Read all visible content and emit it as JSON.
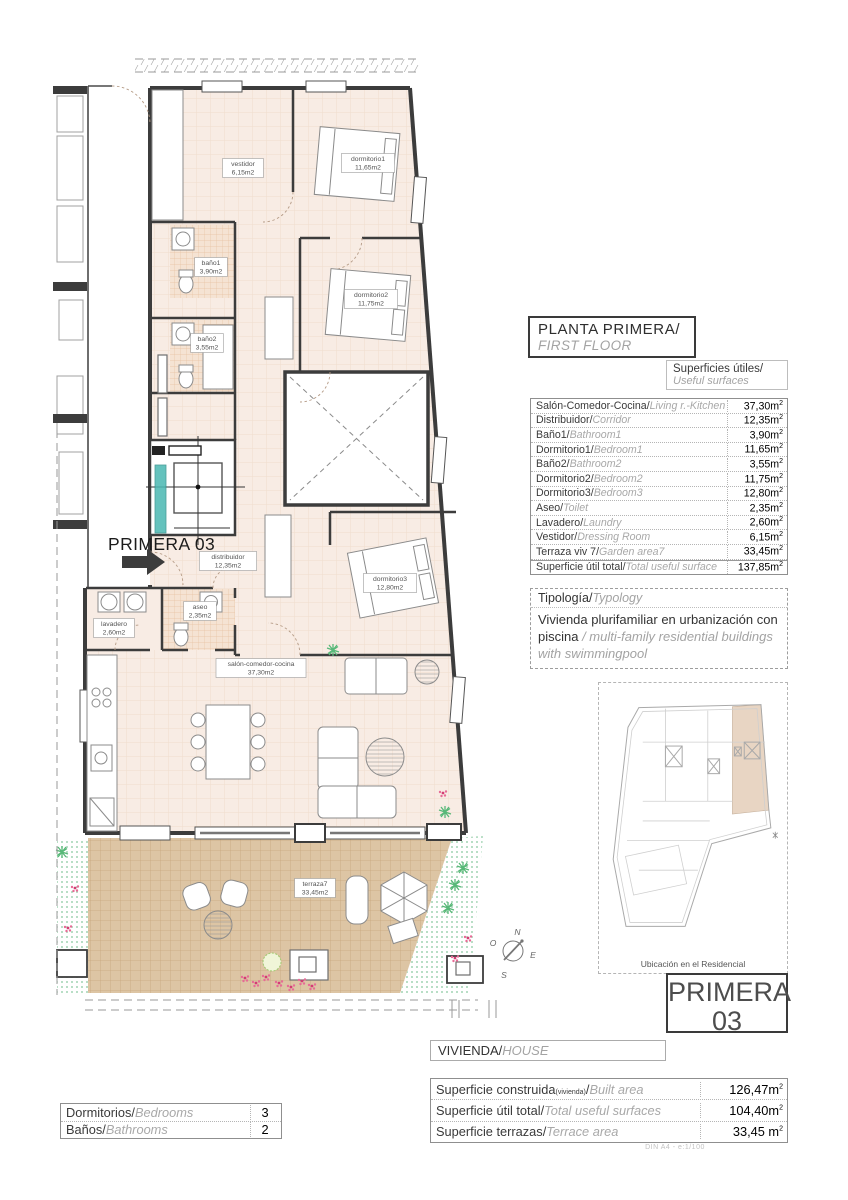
{
  "header": {
    "title_es": "PLANTA PRIMERA/",
    "title_en": "FIRST FLOOR"
  },
  "surfaces": {
    "header_es": "Superficies útiles/",
    "header_en": "Useful surfaces",
    "unit": "m2",
    "rows": [
      {
        "es": "Salón-Comedor-Cocina",
        "en": "Living r.-Kitchen",
        "value": "37,30"
      },
      {
        "es": "Distribuidor",
        "en": "Corridor",
        "value": "12,35"
      },
      {
        "es": "Baño1",
        "en": "Bathroom1",
        "value": "3,90"
      },
      {
        "es": "Dormitorio1",
        "en": "Bedroom1",
        "value": "11,65"
      },
      {
        "es": "Baño2",
        "en": "Bathroom2",
        "value": "3,55"
      },
      {
        "es": "Dormitorio2",
        "en": "Bedroom2",
        "value": "11,75"
      },
      {
        "es": "Dormitorio3",
        "en": "Bedroom3",
        "value": "12,80"
      },
      {
        "es": "Aseo",
        "en": "Toilet",
        "value": "2,35"
      },
      {
        "es": "Lavadero",
        "en": "Laundry",
        "value": "2,60"
      },
      {
        "es": "Vestidor",
        "en": "Dressing Room",
        "value": "6,15"
      },
      {
        "es": "Terraza viv 7",
        "en": "Garden area7",
        "value": "33,45"
      },
      {
        "es": "Superficie útil total",
        "en": "Total useful surface",
        "value": "137,85"
      }
    ]
  },
  "typology": {
    "header_es": "Tipología/",
    "header_en": "Typology",
    "body_es": "Vivienda plurifamiliar en urbanización con piscina ",
    "body_en": "/ multi-family residential buildings with swimmingpool"
  },
  "location_map": {
    "caption": "Ubicación en el Residencial"
  },
  "unit_badge": {
    "line1": "PRIMERA",
    "line2": "03"
  },
  "vivienda": {
    "es": "VIVIENDA/",
    "en": "HOUSE"
  },
  "totals": {
    "rows": [
      {
        "es": "Superficie construida",
        "small": "(vivienda)",
        "en": "Built area",
        "value": "126,47"
      },
      {
        "es": "Superficie útil total",
        "en": "Total useful surfaces",
        "value": "104,40"
      },
      {
        "es": "Superficie terrazas",
        "en": "Terrace area",
        "value": "33,45 "
      }
    ]
  },
  "counts": {
    "rows": [
      {
        "es": "Dormitorios",
        "en": "Bedrooms",
        "value": "3"
      },
      {
        "es": "Baños",
        "en": "Bathrooms",
        "value": "2"
      }
    ]
  },
  "footer": {
    "scale_note": "DIN A4 - e:1/100"
  },
  "plan": {
    "unit_label": "PRIMERA 03",
    "rooms": [
      {
        "name": "vestidor",
        "area": "6,15m2",
        "x": 243,
        "y": 168
      },
      {
        "name": "dormitorio1",
        "area": "11,65m2",
        "x": 368,
        "y": 163
      },
      {
        "name": "baño1",
        "area": "3,90m2",
        "x": 211,
        "y": 267
      },
      {
        "name": "dormitorio2",
        "area": "11,75m2",
        "x": 371,
        "y": 299
      },
      {
        "name": "baño2",
        "area": "3,55m2",
        "x": 207,
        "y": 343
      },
      {
        "name": "distribuidor",
        "area": "12,35m2",
        "x": 228,
        "y": 561
      },
      {
        "name": "dormitorio3",
        "area": "12,80m2",
        "x": 390,
        "y": 583
      },
      {
        "name": "aseo",
        "area": "2,35m2",
        "x": 200,
        "y": 611
      },
      {
        "name": "lavadero",
        "area": "2,60m2",
        "x": 114,
        "y": 628
      },
      {
        "name": "salón-comedor-cocina",
        "area": "37,30m2",
        "x": 261,
        "y": 668
      },
      {
        "name": "terraza7",
        "area": "33,45m2",
        "x": 315,
        "y": 888
      }
    ],
    "compass": {
      "n": "N",
      "s": "S",
      "e": "E",
      "o": "O"
    }
  },
  "colors": {
    "wall": "#3c3c3c",
    "floor": "#f8ece4",
    "bath_tile": "#f5e3d3",
    "terrace": "#ddc5a4",
    "garden_green": "#86c79c",
    "flower_pink": "#e76b96",
    "stair_teal": "#49b8b2",
    "map_highlight": "#e8d5c3"
  }
}
